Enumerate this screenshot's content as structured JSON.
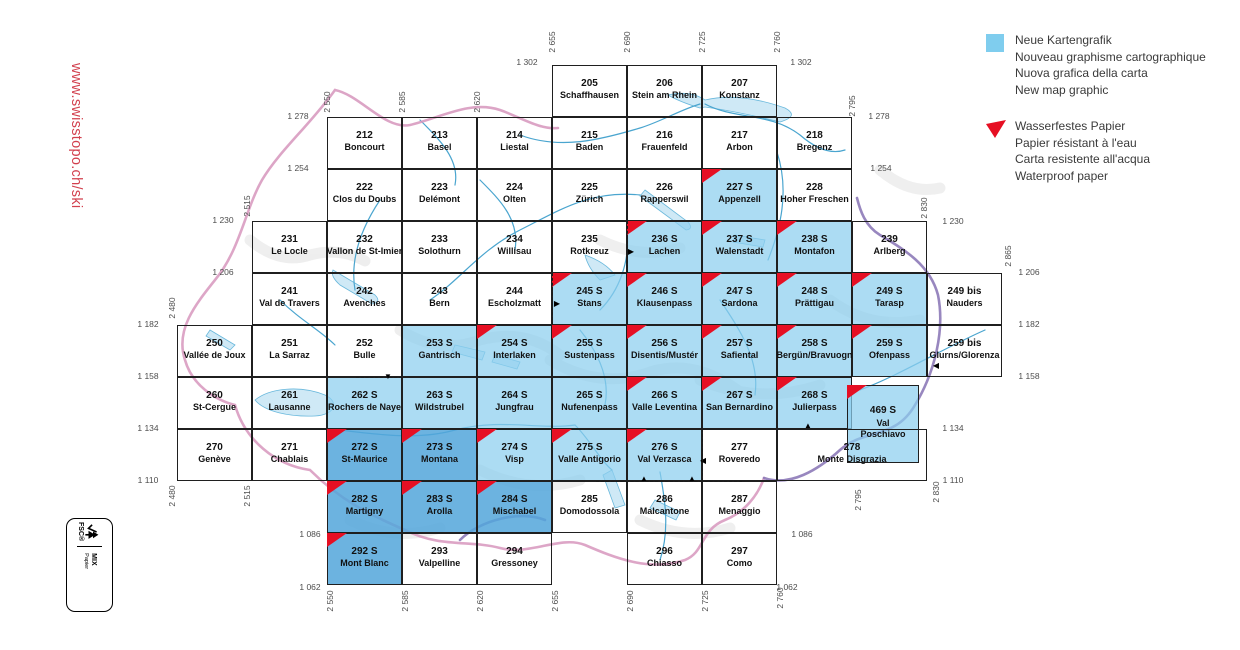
{
  "sidebar": {
    "url": "www.swisstopo.ch/ski"
  },
  "colors": {
    "red": "#e60f23",
    "legend_blue": "#7fcdee",
    "light_blue_fill": "rgba(140,206,238,0.72)",
    "dark_blue_fill": "rgba(82,166,218,0.85)",
    "url_red": "#d2404e"
  },
  "legend": {
    "new_graphic": {
      "swatch_color": "#7fcdee",
      "lines": [
        "Neue Kartengrafik",
        "Nouveau graphisme cartographique",
        "Nuova grafica della carta",
        "New map graphic"
      ]
    },
    "waterproof": {
      "swatch_color": "#e60f23",
      "lines": [
        "Wasserfestes Papier",
        "Papier résistant à l'eau",
        "Carta resistente all'acqua",
        "Waterproof paper"
      ]
    }
  },
  "fsc": {
    "word": "FSC®",
    "mix": "MIX",
    "sub": "Papier"
  },
  "map": {
    "grid": {
      "e0": 2550,
      "x0": 327,
      "n0": 1278,
      "y0": 117,
      "cell_w": 75,
      "cell_h": 52
    },
    "cells": [
      {
        "num": "205",
        "name": "Schaffhausen",
        "e": 2655,
        "n": 1302
      },
      {
        "num": "206",
        "name": "Stein am Rhein",
        "e": 2690,
        "n": 1302
      },
      {
        "num": "207",
        "name": "Konstanz",
        "e": 2725,
        "n": 1302
      },
      {
        "num": "212",
        "name": "Boncourt",
        "e": 2550,
        "n": 1278
      },
      {
        "num": "213",
        "name": "Basel",
        "e": 2585,
        "n": 1278
      },
      {
        "num": "214",
        "name": "Liestal",
        "e": 2620,
        "n": 1278
      },
      {
        "num": "215",
        "name": "Baden",
        "e": 2655,
        "n": 1278
      },
      {
        "num": "216",
        "name": "Frauenfeld",
        "e": 2690,
        "n": 1278
      },
      {
        "num": "217",
        "name": "Arbon",
        "e": 2725,
        "n": 1278
      },
      {
        "num": "218",
        "name": "Bregenz",
        "e": 2760,
        "n": 1278
      },
      {
        "num": "222",
        "name": "Clos du Doubs",
        "e": 2550,
        "n": 1254
      },
      {
        "num": "223",
        "name": "Delémont",
        "e": 2585,
        "n": 1254
      },
      {
        "num": "224",
        "name": "Olten",
        "e": 2620,
        "n": 1254
      },
      {
        "num": "225",
        "name": "Zürich",
        "e": 2655,
        "n": 1254
      },
      {
        "num": "226",
        "name": "Rapperswil",
        "e": 2690,
        "n": 1254
      },
      {
        "num": "227 S",
        "name": "Appenzell",
        "e": 2725,
        "n": 1254,
        "blue": 1,
        "red": 1
      },
      {
        "num": "228",
        "name": "Hoher Freschen",
        "e": 2760,
        "n": 1254
      },
      {
        "num": "231",
        "name": "Le Locle",
        "e": 2515,
        "n": 1230
      },
      {
        "num": "232",
        "name": "Vallon de St-Imier",
        "e": 2550,
        "n": 1230
      },
      {
        "num": "233",
        "name": "Solothurn",
        "e": 2585,
        "n": 1230
      },
      {
        "num": "234",
        "name": "Willisau",
        "e": 2620,
        "n": 1230
      },
      {
        "num": "235",
        "name": "Rotkreuz",
        "e": 2655,
        "n": 1230
      },
      {
        "num": "236 S",
        "name": "Lachen",
        "e": 2690,
        "n": 1230,
        "blue": 1,
        "red": 1
      },
      {
        "num": "237 S",
        "name": "Walenstadt",
        "e": 2725,
        "n": 1230,
        "blue": 1,
        "red": 1
      },
      {
        "num": "238 S",
        "name": "Montafon",
        "e": 2760,
        "n": 1230,
        "blue": 1,
        "red": 1
      },
      {
        "num": "239",
        "name": "Arlberg",
        "e": 2795,
        "n": 1230
      },
      {
        "num": "241",
        "name": "Val de Travers",
        "e": 2515,
        "n": 1206
      },
      {
        "num": "242",
        "name": "Avenches",
        "e": 2550,
        "n": 1206
      },
      {
        "num": "243",
        "name": "Bern",
        "e": 2585,
        "n": 1206
      },
      {
        "num": "244",
        "name": "Escholzmatt",
        "e": 2620,
        "n": 1206
      },
      {
        "num": "245 S",
        "name": "Stans",
        "e": 2655,
        "n": 1206,
        "blue": 1,
        "red": 1
      },
      {
        "num": "246 S",
        "name": "Klausenpass",
        "e": 2690,
        "n": 1206,
        "blue": 1,
        "red": 1
      },
      {
        "num": "247 S",
        "name": "Sardona",
        "e": 2725,
        "n": 1206,
        "blue": 1,
        "red": 1
      },
      {
        "num": "248 S",
        "name": "Prättigau",
        "e": 2760,
        "n": 1206,
        "blue": 1,
        "red": 1
      },
      {
        "num": "249 S",
        "name": "Tarasp",
        "e": 2795,
        "n": 1206,
        "blue": 1,
        "red": 1
      },
      {
        "num": "249 bis",
        "name": "Nauders",
        "e": 2830,
        "n": 1206
      },
      {
        "num": "250",
        "name": "Vallée de Joux",
        "e": 2480,
        "n": 1182
      },
      {
        "num": "251",
        "name": "La Sarraz",
        "e": 2515,
        "n": 1182
      },
      {
        "num": "252",
        "name": "Bulle",
        "e": 2550,
        "n": 1182
      },
      {
        "num": "253 S",
        "name": "Gantrisch",
        "e": 2585,
        "n": 1182,
        "blue": 1
      },
      {
        "num": "254 S",
        "name": "Interlaken",
        "e": 2620,
        "n": 1182,
        "blue": 1,
        "red": 1
      },
      {
        "num": "255 S",
        "name": "Sustenpass",
        "e": 2655,
        "n": 1182,
        "blue": 1,
        "red": 1
      },
      {
        "num": "256 S",
        "name": "Disentis/Mustér",
        "e": 2690,
        "n": 1182,
        "blue": 1,
        "red": 1
      },
      {
        "num": "257 S",
        "name": "Safiental",
        "e": 2725,
        "n": 1182,
        "blue": 1,
        "red": 1
      },
      {
        "num": "258 S",
        "name": "Bergün/Bravuogn",
        "e": 2760,
        "n": 1182,
        "blue": 1,
        "red": 1
      },
      {
        "num": "259 S",
        "name": "Ofenpass",
        "e": 2795,
        "n": 1182,
        "blue": 1,
        "red": 1
      },
      {
        "num": "259 bis",
        "name": "Glurns/Glorenza",
        "e": 2830,
        "n": 1182
      },
      {
        "num": "260",
        "name": "St-Cergue",
        "e": 2480,
        "n": 1158
      },
      {
        "num": "261",
        "name": "Lausanne",
        "e": 2515,
        "n": 1158
      },
      {
        "num": "262 S",
        "name": "Rochers de Naye",
        "e": 2550,
        "n": 1158,
        "blue": 1
      },
      {
        "num": "263 S",
        "name": "Wildstrubel",
        "e": 2585,
        "n": 1158,
        "blue": 1
      },
      {
        "num": "264 S",
        "name": "Jungfrau",
        "e": 2620,
        "n": 1158,
        "blue": 1
      },
      {
        "num": "265 S",
        "name": "Nufenenpass",
        "e": 2655,
        "n": 1158,
        "blue": 1
      },
      {
        "num": "266 S",
        "name": "Valle Leventina",
        "e": 2690,
        "n": 1158,
        "blue": 1,
        "red": 1
      },
      {
        "num": "267 S",
        "name": "San Bernardino",
        "e": 2725,
        "n": 1158,
        "blue": 1,
        "red": 1
      },
      {
        "num": "268 S",
        "name": "Julierpass",
        "e": 2760,
        "n": 1158,
        "blue": 1,
        "red": 1
      },
      {
        "num": "469 S",
        "name": [
          "Val",
          "Poschiavo"
        ],
        "e": 2795,
        "n": 1158,
        "blue": 1,
        "red": 1,
        "px": {
          "x": 847,
          "y": 385,
          "w": 72,
          "h": 78
        }
      },
      {
        "num": "270",
        "name": "Genève",
        "e": 2480,
        "n": 1134
      },
      {
        "num": "271",
        "name": "Chablais",
        "e": 2515,
        "n": 1134
      },
      {
        "num": "272 S",
        "name": "St-Maurice",
        "e": 2550,
        "n": 1134,
        "blue": 1,
        "dark": 1,
        "red": 1
      },
      {
        "num": "273 S",
        "name": "Montana",
        "e": 2585,
        "n": 1134,
        "blue": 1,
        "dark": 1,
        "red": 1
      },
      {
        "num": "274 S",
        "name": "Visp",
        "e": 2620,
        "n": 1134,
        "blue": 1,
        "red": 1
      },
      {
        "num": "275 S",
        "name": "Valle Antigorio",
        "e": 2655,
        "n": 1134,
        "blue": 1,
        "red": 1
      },
      {
        "num": "276 S",
        "name": "Val Verzasca",
        "e": 2690,
        "n": 1134,
        "blue": 1,
        "red": 1
      },
      {
        "num": "277",
        "name": "Roveredo",
        "e": 2725,
        "n": 1134
      },
      {
        "num": "278",
        "name": "Monte Disgrazia",
        "e": 2760,
        "n": 1134,
        "wkm": 70
      },
      {
        "num": "282 S",
        "name": "Martigny",
        "e": 2550,
        "n": 1110,
        "blue": 1,
        "dark": 1,
        "red": 1
      },
      {
        "num": "283 S",
        "name": "Arolla",
        "e": 2585,
        "n": 1110,
        "blue": 1,
        "dark": 1,
        "red": 1
      },
      {
        "num": "284 S",
        "name": "Mischabel",
        "e": 2620,
        "n": 1110,
        "blue": 1,
        "dark": 1,
        "red": 1
      },
      {
        "num": "285",
        "name": "Domodossola",
        "e": 2655,
        "n": 1110
      },
      {
        "num": "286",
        "name": "Malcantone",
        "e": 2690,
        "n": 1110
      },
      {
        "num": "287",
        "name": "Menaggio",
        "e": 2725,
        "n": 1110
      },
      {
        "num": "292 S",
        "name": "Mont Blanc",
        "e": 2550,
        "n": 1086,
        "blue": 1,
        "dark": 1,
        "red": 1
      },
      {
        "num": "293",
        "name": "Valpelline",
        "e": 2585,
        "n": 1086
      },
      {
        "num": "294",
        "name": "Gressoney",
        "e": 2620,
        "n": 1086
      },
      {
        "num": "296",
        "name": "Chiasso",
        "e": 2690,
        "n": 1086
      },
      {
        "num": "297",
        "name": "Como",
        "e": 2725,
        "n": 1086
      }
    ],
    "coord_labels": {
      "vertical": [
        {
          "t": "2 655",
          "x": 552,
          "y": 42
        },
        {
          "t": "2 690",
          "x": 627,
          "y": 42
        },
        {
          "t": "2 725",
          "x": 702,
          "y": 42
        },
        {
          "t": "2 760",
          "x": 777,
          "y": 42
        },
        {
          "t": "2 550",
          "x": 327,
          "y": 102
        },
        {
          "t": "2 585",
          "x": 402,
          "y": 102
        },
        {
          "t": "2 620",
          "x": 477,
          "y": 102
        },
        {
          "t": "2 795",
          "x": 852,
          "y": 106
        },
        {
          "t": "2 515",
          "x": 247,
          "y": 206
        },
        {
          "t": "2 830",
          "x": 924,
          "y": 208
        },
        {
          "t": "2 865",
          "x": 1008,
          "y": 256
        },
        {
          "t": "2 480",
          "x": 172,
          "y": 308
        },
        {
          "t": "2 480",
          "x": 172,
          "y": 496
        },
        {
          "t": "2 515",
          "x": 247,
          "y": 496
        },
        {
          "t": "2 795",
          "x": 858,
          "y": 500
        },
        {
          "t": "2 830",
          "x": 936,
          "y": 492
        },
        {
          "t": "2 550",
          "x": 330,
          "y": 601
        },
        {
          "t": "2 585",
          "x": 405,
          "y": 601
        },
        {
          "t": "2 620",
          "x": 480,
          "y": 601
        },
        {
          "t": "2 655",
          "x": 555,
          "y": 601
        },
        {
          "t": "2 690",
          "x": 630,
          "y": 601
        },
        {
          "t": "2 725",
          "x": 705,
          "y": 601
        },
        {
          "t": "2 760",
          "x": 780,
          "y": 598
        }
      ],
      "horizontal": [
        {
          "t": "1 302",
          "x": 527,
          "y": 62
        },
        {
          "t": "1 302",
          "x": 801,
          "y": 62
        },
        {
          "t": "1 278",
          "x": 298,
          "y": 116
        },
        {
          "t": "1 278",
          "x": 879,
          "y": 116
        },
        {
          "t": "1 254",
          "x": 298,
          "y": 168
        },
        {
          "t": "1 254",
          "x": 881,
          "y": 168
        },
        {
          "t": "1 230",
          "x": 223,
          "y": 220
        },
        {
          "t": "1 230",
          "x": 953,
          "y": 221
        },
        {
          "t": "1 206",
          "x": 223,
          "y": 272
        },
        {
          "t": "1 206",
          "x": 1029,
          "y": 272
        },
        {
          "t": "1 182",
          "x": 148,
          "y": 324
        },
        {
          "t": "1 182",
          "x": 1029,
          "y": 324
        },
        {
          "t": "1 158",
          "x": 148,
          "y": 376
        },
        {
          "t": "1 158",
          "x": 1029,
          "y": 376
        },
        {
          "t": "1 134",
          "x": 148,
          "y": 428
        },
        {
          "t": "1 134",
          "x": 953,
          "y": 428
        },
        {
          "t": "1 110",
          "x": 148,
          "y": 480
        },
        {
          "t": "1 110",
          "x": 953,
          "y": 480
        },
        {
          "t": "1 086",
          "x": 310,
          "y": 534
        },
        {
          "t": "1 086",
          "x": 802,
          "y": 534
        },
        {
          "t": "1 062",
          "x": 310,
          "y": 587
        },
        {
          "t": "1 062",
          "x": 787,
          "y": 587
        }
      ]
    },
    "markers": [
      {
        "g": "▶",
        "x": 631,
        "y": 252
      },
      {
        "g": "▶",
        "x": 557,
        "y": 304
      },
      {
        "g": "▼",
        "x": 388,
        "y": 377
      },
      {
        "g": "▲",
        "x": 808,
        "y": 426
      },
      {
        "g": "◀",
        "x": 936,
        "y": 366
      },
      {
        "g": "◀",
        "x": 703,
        "y": 461
      },
      {
        "g": "▲",
        "x": 644,
        "y": 479
      },
      {
        "g": "▲",
        "x": 692,
        "y": 479
      }
    ],
    "dashes": [
      {
        "o": "v",
        "x": 627,
        "y": 221,
        "len": 52
      },
      {
        "o": "v",
        "x": 552,
        "y": 273,
        "len": 52
      },
      {
        "o": "h",
        "x": 356,
        "y": 377,
        "len": 46
      },
      {
        "o": "v",
        "x": 702,
        "y": 429,
        "len": 52
      },
      {
        "o": "h",
        "x": 596,
        "y": 481,
        "len": 146
      }
    ]
  }
}
